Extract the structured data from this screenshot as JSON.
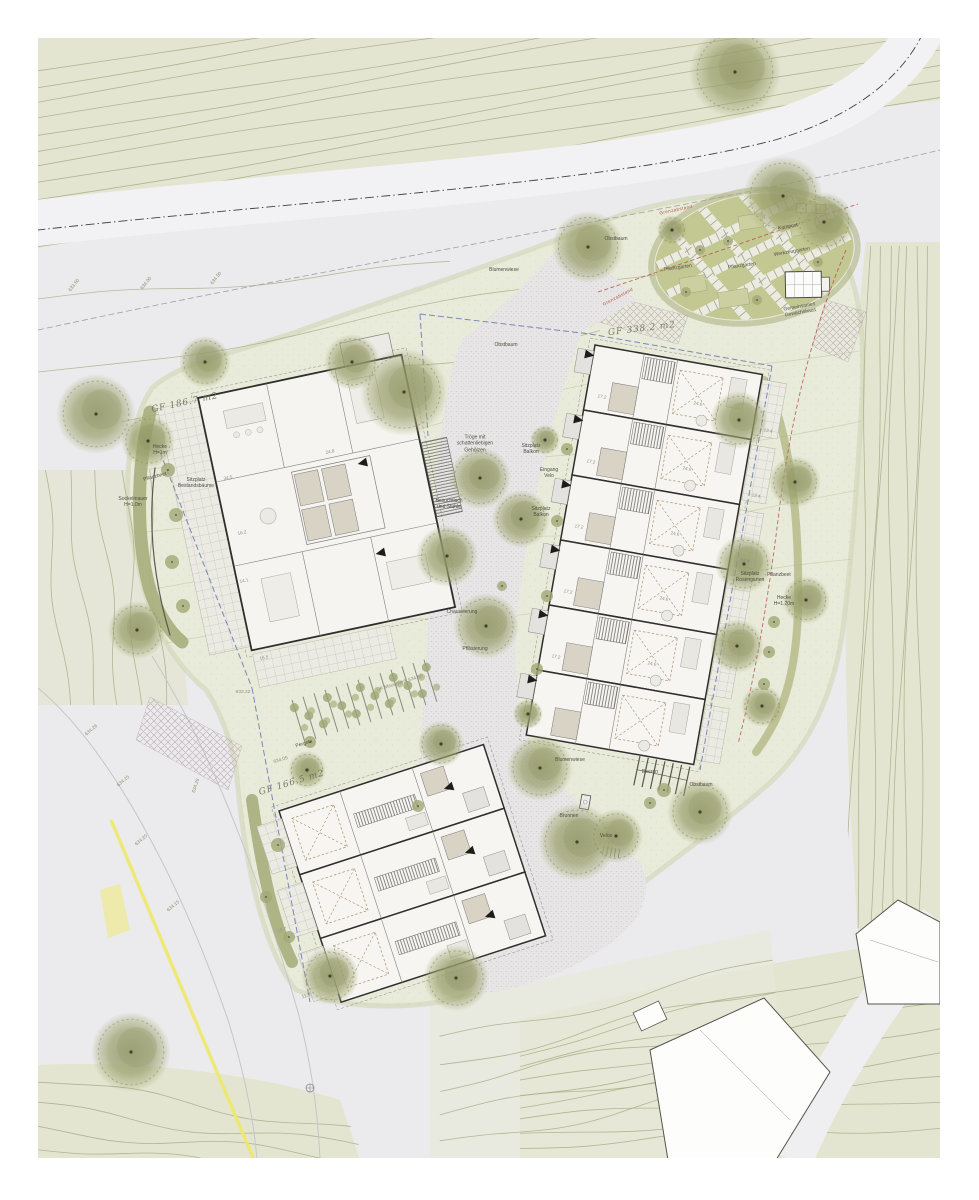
{
  "colors": {
    "page_bg": "#ffffff",
    "ground": "#ebebed",
    "hill_green": "#e3e5d1",
    "site_green": "#e9ebda",
    "garden_green": "#c3c893",
    "contour": "#a9ac85",
    "road": "#f2f2f4",
    "paving_dot": "#b8b6b6",
    "wall": "#2e2e2c",
    "bath": "#d9d3c5",
    "hedge": "#a9ae7c",
    "accent_red": "#b3524a",
    "accent_blue": "#5e6fae",
    "accent_yellow": "#efe96a",
    "label": "#4e4f44",
    "gf_label": "#6e6e5a"
  },
  "plan": {
    "buildings": {
      "left_multifamily": {
        "area_label": "GF 186.7 m2"
      },
      "right_rowhouses": {
        "area_label": "GF 338.2 m2"
      },
      "bottom_rowhouses": {
        "area_label": "GF 166.5 m2"
      }
    }
  },
  "annotations": [
    {
      "t": "GF 186.7 m2",
      "x": 185,
      "y": 404,
      "r": -12,
      "c": "gf"
    },
    {
      "t": "GF 338.2 m2",
      "x": 642,
      "y": 330,
      "r": -7,
      "c": "gf"
    },
    {
      "t": "GF 166.5 m2",
      "x": 292,
      "y": 784,
      "r": -17,
      "c": "gf"
    },
    {
      "t": "Kompost",
      "x": 788,
      "y": 227,
      "r": -10
    },
    {
      "t": "Werkzeuggarten",
      "x": 792,
      "y": 252,
      "r": -10
    },
    {
      "t": "Pflanzgarten",
      "x": 742,
      "y": 266,
      "r": -8
    },
    {
      "t": "Pflanzgarten",
      "x": 678,
      "y": 268,
      "r": -8
    },
    {
      "t": "Gemeinsames\nGewächshaus",
      "x": 800,
      "y": 310,
      "r": -10
    },
    {
      "t": "Obstbaum",
      "x": 616,
      "y": 239,
      "r": 0
    },
    {
      "t": "Obstbaum",
      "x": 506,
      "y": 345,
      "r": 0
    },
    {
      "t": "Obstbaum",
      "x": 701,
      "y": 785,
      "r": 0
    },
    {
      "t": "Blumenwiese",
      "x": 504,
      "y": 270,
      "r": 0
    },
    {
      "t": "Blumenwiese",
      "x": 570,
      "y": 760,
      "r": 0
    },
    {
      "t": "Tröge mit\nschattenliebigen\nGehölzen",
      "x": 475,
      "y": 444,
      "r": 0
    },
    {
      "t": "Besuchtisch\nund Stühle",
      "x": 449,
      "y": 504,
      "r": 0
    },
    {
      "t": "Chaussierung",
      "x": 462,
      "y": 612,
      "r": 0
    },
    {
      "t": "Pflästerung",
      "x": 475,
      "y": 649,
      "r": 0
    },
    {
      "t": "Sitzplatz\nBalkon",
      "x": 531,
      "y": 449,
      "r": 0
    },
    {
      "t": "Eingang\nVelo",
      "x": 549,
      "y": 473,
      "r": 0
    },
    {
      "t": "Sitzplatz\nBalkon",
      "x": 541,
      "y": 512,
      "r": 0
    },
    {
      "t": "Sitzplatz\nRosengarten",
      "x": 750,
      "y": 577,
      "r": 0
    },
    {
      "t": "Pflanzbeet",
      "x": 779,
      "y": 575,
      "r": 0
    },
    {
      "t": "Hecke\nH=1.20m",
      "x": 784,
      "y": 601,
      "r": 0
    },
    {
      "t": "Hecke\nH=1m",
      "x": 160,
      "y": 450,
      "r": 0
    },
    {
      "t": "Pflanzbeet",
      "x": 155,
      "y": 477,
      "r": -15
    },
    {
      "t": "Sitzplatz\nBestandsbäume",
      "x": 196,
      "y": 483,
      "r": 0
    },
    {
      "t": "Sockelmauer\nH=1.0m",
      "x": 133,
      "y": 502,
      "r": 0
    },
    {
      "t": "Pergola",
      "x": 304,
      "y": 744,
      "r": -17
    },
    {
      "t": "634.05",
      "x": 281,
      "y": 761,
      "r": -17,
      "c": "elev"
    },
    {
      "t": "633.22",
      "x": 243,
      "y": 693,
      "r": 0,
      "c": "elev"
    },
    {
      "t": "UK Mauerwerk 634.50",
      "x": 400,
      "y": 684,
      "r": -17,
      "c": "elev"
    },
    {
      "t": "634.26",
      "x": 92,
      "y": 731,
      "r": -40,
      "c": "elev"
    },
    {
      "t": "634.25",
      "x": 124,
      "y": 782,
      "r": -40,
      "c": "elev"
    },
    {
      "t": "634.20",
      "x": 142,
      "y": 841,
      "r": -40,
      "c": "elev"
    },
    {
      "t": "634.26",
      "x": 197,
      "y": 786,
      "r": -72,
      "c": "elev"
    },
    {
      "t": "634.15",
      "x": 174,
      "y": 907,
      "r": -40,
      "c": "elev"
    },
    {
      "t": "633.50",
      "x": 75,
      "y": 286,
      "r": -52,
      "c": "elev"
    },
    {
      "t": "634.00",
      "x": 147,
      "y": 284,
      "r": -52,
      "c": "elev"
    },
    {
      "t": "634.50",
      "x": 217,
      "y": 279,
      "r": -52,
      "c": "elev"
    },
    {
      "t": "Brunnen",
      "x": 569,
      "y": 816,
      "r": 0
    },
    {
      "t": "Velos",
      "x": 606,
      "y": 836,
      "r": 0
    },
    {
      "t": "Beeren",
      "x": 650,
      "y": 772,
      "r": 0
    },
    {
      "t": "Grenzabstand",
      "x": 676,
      "y": 210,
      "r": -12,
      "c": "red"
    },
    {
      "t": "Grenzabstand",
      "x": 618,
      "y": 297,
      "r": -28,
      "c": "red"
    },
    {
      "t": "34.5",
      "x": 228,
      "y": 478,
      "r": -12,
      "c": "num"
    },
    {
      "t": "16.2",
      "x": 242,
      "y": 533,
      "r": -12,
      "c": "num"
    },
    {
      "t": "14.1",
      "x": 244,
      "y": 581,
      "r": -12,
      "c": "num"
    },
    {
      "t": "16.5",
      "x": 264,
      "y": 658,
      "r": -12,
      "c": "num"
    },
    {
      "t": "24.8",
      "x": 330,
      "y": 452,
      "r": -12,
      "c": "num"
    },
    {
      "t": "17.2",
      "x": 602,
      "y": 397,
      "r": 10,
      "c": "num"
    },
    {
      "t": "17.2",
      "x": 591,
      "y": 462,
      "r": 10,
      "c": "num"
    },
    {
      "t": "17.2",
      "x": 579,
      "y": 527,
      "r": 10,
      "c": "num"
    },
    {
      "t": "17.2",
      "x": 568,
      "y": 592,
      "r": 10,
      "c": "num"
    },
    {
      "t": "17.2",
      "x": 556,
      "y": 657,
      "r": 10,
      "c": "num"
    },
    {
      "t": "24.6",
      "x": 698,
      "y": 404,
      "r": 10,
      "c": "num"
    },
    {
      "t": "24.6",
      "x": 687,
      "y": 469,
      "r": 10,
      "c": "num"
    },
    {
      "t": "24.6",
      "x": 675,
      "y": 534,
      "r": 10,
      "c": "num"
    },
    {
      "t": "24.6",
      "x": 664,
      "y": 599,
      "r": 10,
      "c": "num"
    },
    {
      "t": "24.6",
      "x": 652,
      "y": 664,
      "r": 10,
      "c": "num"
    },
    {
      "t": "13.4",
      "x": 768,
      "y": 431,
      "r": 10,
      "c": "num"
    },
    {
      "t": "13.4",
      "x": 756,
      "y": 496,
      "r": 10,
      "c": "num"
    },
    {
      "t": "13.4",
      "x": 745,
      "y": 561,
      "r": 10,
      "c": "num"
    },
    {
      "t": "15.7",
      "x": 282,
      "y": 930,
      "r": -17,
      "c": "num"
    },
    {
      "t": "11.3",
      "x": 306,
      "y": 996,
      "r": -17,
      "c": "num"
    }
  ],
  "vegetation": {
    "trees": [
      [
        735,
        72,
        46
      ],
      [
        783,
        196,
        40
      ],
      [
        824,
        222,
        30
      ],
      [
        588,
        247,
        36
      ],
      [
        672,
        230,
        15
      ],
      [
        404,
        392,
        44
      ],
      [
        352,
        362,
        28
      ],
      [
        205,
        362,
        26
      ],
      [
        96,
        414,
        40
      ],
      [
        148,
        441,
        27
      ],
      [
        137,
        630,
        29
      ],
      [
        480,
        478,
        31
      ],
      [
        521,
        519,
        29
      ],
      [
        447,
        556,
        31
      ],
      [
        486,
        626,
        33
      ],
      [
        545,
        440,
        15
      ],
      [
        528,
        714,
        15
      ],
      [
        739,
        420,
        29
      ],
      [
        795,
        482,
        26
      ],
      [
        744,
        564,
        29
      ],
      [
        806,
        600,
        24
      ],
      [
        737,
        646,
        27
      ],
      [
        762,
        706,
        21
      ],
      [
        540,
        768,
        33
      ],
      [
        577,
        842,
        39
      ],
      [
        616,
        836,
        27
      ],
      [
        700,
        812,
        33
      ],
      [
        307,
        770,
        19
      ],
      [
        441,
        744,
        23
      ],
      [
        330,
        976,
        29
      ],
      [
        456,
        978,
        33
      ],
      [
        131,
        1052,
        40
      ]
    ],
    "shrubs": [
      [
        168,
        470,
        7
      ],
      [
        176,
        515,
        7
      ],
      [
        172,
        562,
        7
      ],
      [
        183,
        606,
        7
      ],
      [
        567,
        449,
        6
      ],
      [
        557,
        521,
        6
      ],
      [
        547,
        596,
        6
      ],
      [
        537,
        669,
        6
      ],
      [
        700,
        250,
        5
      ],
      [
        728,
        241,
        5
      ],
      [
        757,
        300,
        5
      ],
      [
        818,
        262,
        5
      ],
      [
        686,
        292,
        5
      ],
      [
        664,
        790,
        7
      ],
      [
        650,
        803,
        6
      ],
      [
        774,
        622,
        6
      ],
      [
        769,
        652,
        6
      ],
      [
        764,
        684,
        6
      ],
      [
        278,
        845,
        7
      ],
      [
        266,
        897,
        6
      ],
      [
        289,
        937,
        6
      ],
      [
        418,
        806,
        6
      ],
      [
        502,
        586,
        5
      ],
      [
        310,
        742,
        6
      ]
    ]
  },
  "entrance_arrows": [
    {
      "x": 585,
      "y": 354,
      "rot": 10,
      "dir": "right"
    },
    {
      "x": 574,
      "y": 419,
      "rot": 10,
      "dir": "right"
    },
    {
      "x": 562,
      "y": 484,
      "rot": 10,
      "dir": "right"
    },
    {
      "x": 551,
      "y": 549,
      "rot": 10,
      "dir": "right"
    },
    {
      "x": 539,
      "y": 614,
      "rot": 10,
      "dir": "right"
    },
    {
      "x": 528,
      "y": 679,
      "rot": 10,
      "dir": "right"
    },
    {
      "x": 367,
      "y": 462,
      "rot": -12,
      "dir": "left"
    },
    {
      "x": 385,
      "y": 552,
      "rot": -12,
      "dir": "left"
    },
    {
      "x": 453,
      "y": 786,
      "rot": -18,
      "dir": "left"
    },
    {
      "x": 474,
      "y": 850,
      "rot": -18,
      "dir": "left"
    },
    {
      "x": 494,
      "y": 914,
      "rot": -18,
      "dir": "left"
    }
  ]
}
